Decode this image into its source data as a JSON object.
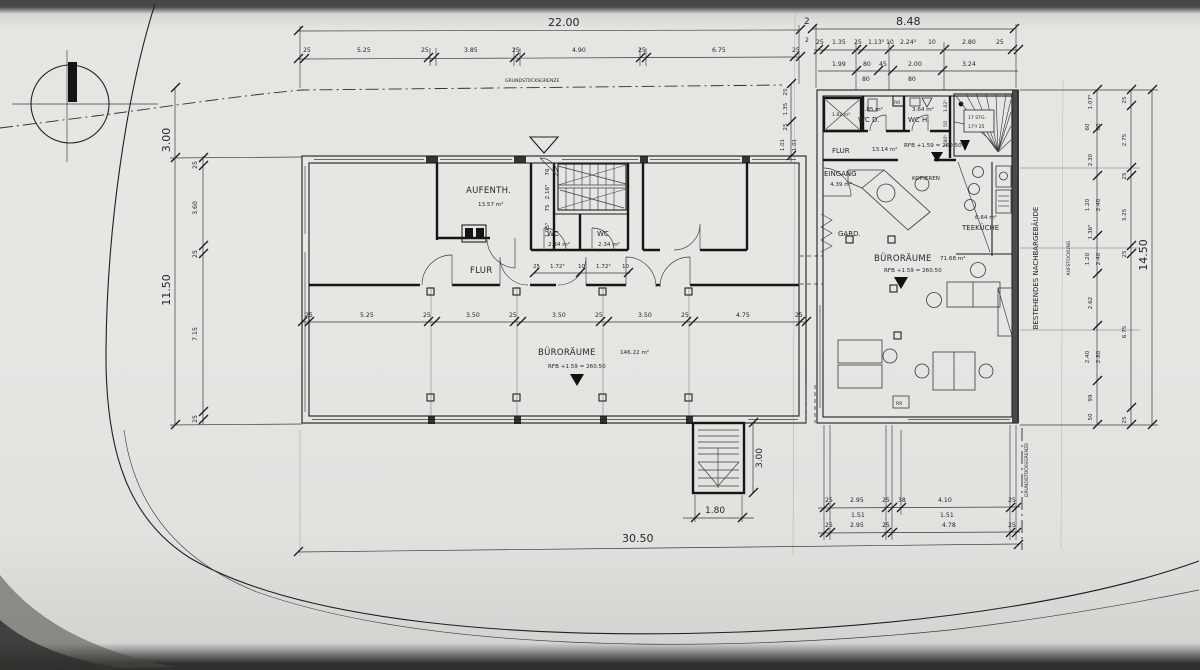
{
  "labels": {
    "grenze_top": "GRUNDSTÜCKSGRENZE",
    "grenze_right": "GRUNDSTÜCKSGRENZE",
    "nachbar": "BESTEHENDES NACHBARGEBÄUDE",
    "aufstockung": "AUFSTOCKUNG"
  },
  "rooms": {
    "aufenth": {
      "name": "AUFENTH.",
      "area": "13.57 m²"
    },
    "wc1": {
      "name": "WC",
      "area": "2.34 m²"
    },
    "wc2": {
      "name": "WC",
      "area": "2.34 m²"
    },
    "flur_left": "FLUR",
    "buero_left": {
      "name": "BÜRORÄUME",
      "area": "146.22 m²",
      "level": "RFB +1.59 = 260.50"
    },
    "flur_right": {
      "name": "FLUR",
      "area": "13.14 m²",
      "level": "RFB +1.59 = 260.50"
    },
    "eingang": {
      "name": "EINGANG",
      "area": "4.39 m²"
    },
    "gard": "GARD.",
    "kopieren": "KOPIEREN",
    "aufzug_area": "1.82 m²",
    "wc_d": {
      "name": "WC D.",
      "area": "1.85 m²"
    },
    "wc_h": {
      "name": "WC H.",
      "area": "3.64 m²"
    },
    "stair": {
      "line1": "17 STG.",
      "line2": "17⁵/ 25"
    },
    "teekueche": {
      "name": "TEEKÜCHE",
      "area": "6.64 m²"
    },
    "buero_right": {
      "name": "BÜRORÄUME",
      "area": "71.68 m²",
      "level": "RFB +1.59 = 260.50"
    },
    "rr1": "RR",
    "rr2": "RR"
  },
  "dims": {
    "top_main": [
      "22.00",
      "2",
      "8.48"
    ],
    "top_gap_sub": "2",
    "top_left_chain": [
      "25",
      "5.25",
      "25",
      "3.85",
      "25",
      "4.90",
      "25",
      "6.75",
      "25"
    ],
    "top_right_chain": [
      "25",
      "1.35",
      "25",
      "1.13⁵",
      "10",
      "2.24⁵",
      "10",
      "2.80",
      "25"
    ],
    "top_right_chain2": [
      "1.99",
      "80",
      "45",
      "2.00",
      "3.24"
    ],
    "top_right_chain3": [
      "80",
      "80"
    ],
    "left_upper": "3.00",
    "left_overall": "11.50",
    "left_chain": [
      "25",
      "3.60",
      "25",
      "7.15",
      "25"
    ],
    "stair_side_chain": [
      "76",
      "2.16⁵",
      "75",
      "1.95⁵"
    ],
    "wc_chain": [
      "25",
      "1.72⁵",
      "10",
      "1.72⁵",
      "10"
    ],
    "corridor_chain": [
      "25",
      "5.25",
      "25",
      "3.50",
      "25",
      "3.50",
      "25",
      "3.50",
      "25",
      "4.75",
      "25"
    ],
    "gap_chain": [
      "25",
      "1.35",
      "25",
      "1.01",
      "1.01"
    ],
    "stair_right_chain": [
      "1.62⁵",
      "50",
      "1.80⁵"
    ],
    "right_inner_chain": [
      "1.07⁵",
      "60",
      "60",
      "2.30",
      "1.20",
      "2.40",
      "1.36⁵",
      "1.20",
      "2.40",
      "2.62",
      "2.40",
      "2.80",
      "99",
      "50"
    ],
    "right_outer_chain": [
      "25",
      "2.75",
      "25",
      "3.25",
      "25",
      "6.75",
      "25"
    ],
    "right_overall": "14.50",
    "bottom_right_row1": [
      "25",
      "2.95",
      "25",
      "38",
      "4.10",
      "25"
    ],
    "bottom_right_row1b": [
      "1.51",
      "1.51"
    ],
    "bottom_right_row2": [
      "25",
      "2.95",
      "25",
      "4.78",
      "25"
    ],
    "exit_stair_width": "1.80",
    "exit_stair_depth": "3.00",
    "bottom_overall": "30.50"
  }
}
